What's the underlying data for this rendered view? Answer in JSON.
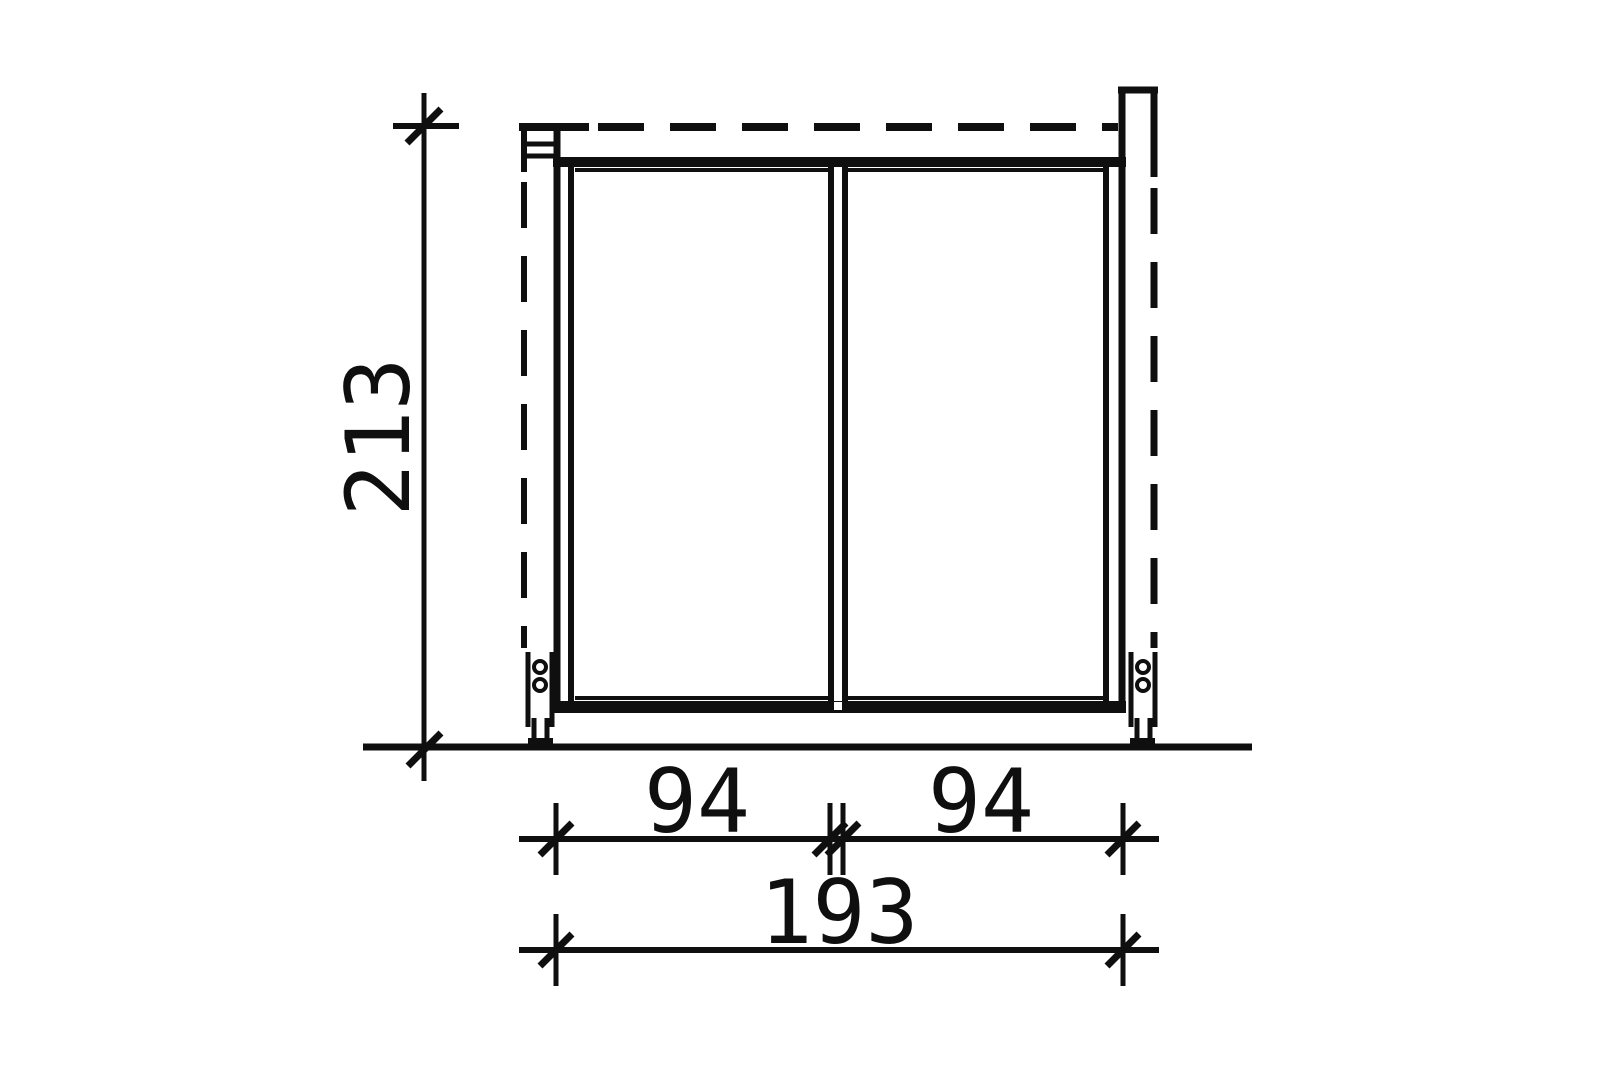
{
  "drawing": {
    "background_color": "#ffffff",
    "ink_color": "#0f0f0f",
    "dimensions": {
      "height": "213",
      "bay_left_width": "94",
      "bay_right_width": "94",
      "overall_width": "193"
    }
  }
}
